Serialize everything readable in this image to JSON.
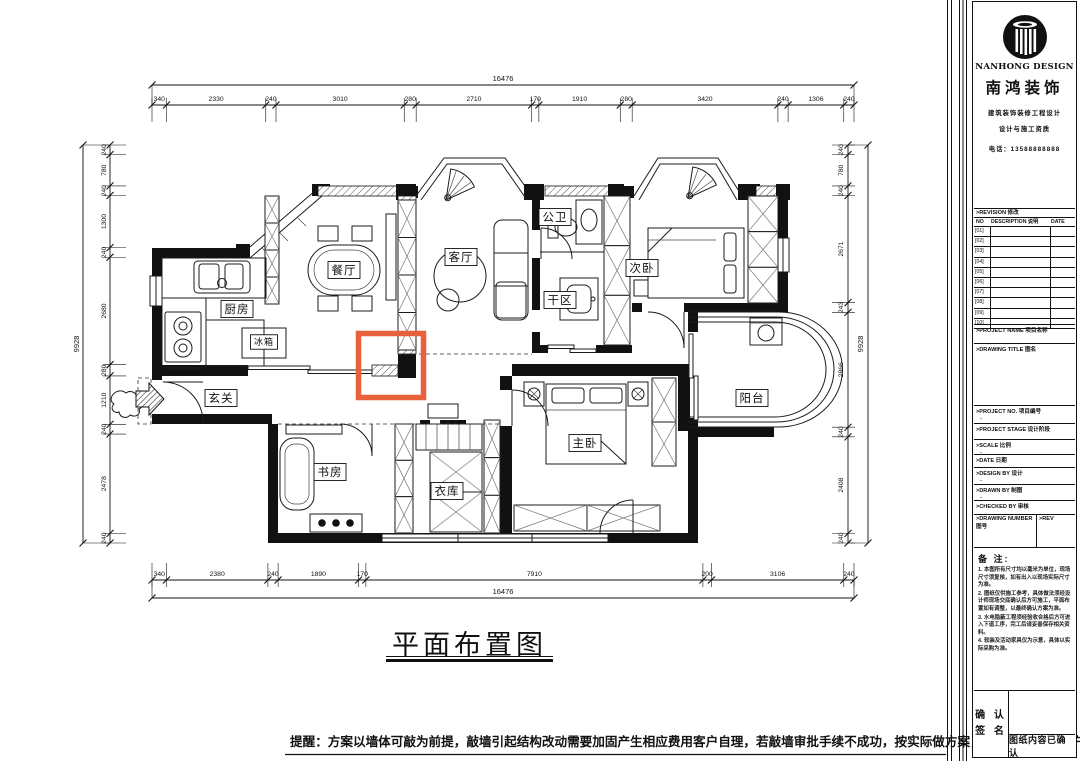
{
  "plan": {
    "title": "平面布置图",
    "reminder": "提醒：方案以墙体可敲为前提，敲墙引起结构改动需要加固产生相应费用客户自理，若敲墙审批手续不成功，按实际做方案，其中产生费用客户自理。",
    "highlight_color": "#E8613C",
    "rooms": [
      {
        "id": "kitchen",
        "label": "厨房"
      },
      {
        "id": "fridge",
        "label": "冰箱"
      },
      {
        "id": "dining",
        "label": "餐厅"
      },
      {
        "id": "living",
        "label": "客厅"
      },
      {
        "id": "bath",
        "label": "公卫"
      },
      {
        "id": "dry",
        "label": "干区"
      },
      {
        "id": "bed2",
        "label": "次卧"
      },
      {
        "id": "entry",
        "label": "玄关"
      },
      {
        "id": "study",
        "label": "书房"
      },
      {
        "id": "cloak",
        "label": "衣库"
      },
      {
        "id": "master",
        "label": "主卧"
      },
      {
        "id": "balcony",
        "label": "阳台"
      }
    ]
  },
  "dimensions": {
    "top": {
      "total": "16476",
      "segments": [
        340,
        2330,
        240,
        3010,
        280,
        2710,
        170,
        1910,
        280,
        3420,
        240,
        1306,
        240
      ]
    },
    "bottom": {
      "total": "16476",
      "segments": [
        340,
        2380,
        240,
        1890,
        170,
        7910,
        200,
        3106,
        240
      ]
    },
    "left": {
      "total": "9928",
      "segments": [
        240,
        780,
        240,
        1300,
        240,
        2680,
        280,
        1210,
        240,
        2478,
        240
      ]
    },
    "right": {
      "total": "9928",
      "segments": [
        240,
        780,
        240,
        2671,
        243,
        2866,
        240,
        2408,
        240
      ]
    }
  },
  "title_block": {
    "brand_en": "NANHONG DESIGN",
    "brand_cn": "南鸿装饰",
    "sub1": "建筑装饰装修工程设计",
    "sub2": "设计与施工资质",
    "sub3": "电话：13588888888",
    "revision": {
      "header": ">REVISION 修改",
      "col_no": "NO",
      "col_desc": "DESCRIPTION 说明",
      "col_date": "DATE",
      "rows": [
        "01",
        "02",
        "03",
        "04",
        "05",
        "06",
        "07",
        "08",
        "09",
        "10"
      ]
    },
    "fields": {
      "project_name": ">PROJECT NAME 项目名称",
      "drawing_title": ">DRAWING TITLE 图名",
      "project_no": ">PROJECT NO. 项目编号",
      "project_no_value": "-",
      "project_stage": ">PROJECT STAGE 设计阶段",
      "scale": ">SCALE 比例",
      "scale_value": "-",
      "date": ">DATE 日期",
      "design_by": ">DESIGN BY 设计",
      "design_by_value": "-",
      "drawn_by": ">DRAWN BY 制图",
      "drawn_by_value": "-",
      "checked_by": ">CHECKED BY 审核",
      "drawing_number": ">DRAWING NUMBER 图号",
      "rev": ">REV"
    },
    "notes_title": "备 注:",
    "notes": [
      "1. 本图所有尺寸均以毫米为单位，现场尺寸须复核，如有出入以现场实际尺寸为准。",
      "2. 图纸仅供施工参考，具体做法须经设计师现场交底确认后方可施工，平面布置如有调整，以最终确认方案为准。",
      "3. 水电隐蔽工程须经验收合格后方可进入下道工序，完工后请妥善保存相关资料。",
      "4. 软装及活动家具仅为示意，具体以实际采购为准。"
    ],
    "confirm_line1": "确 认",
    "confirm_line2": "签 名",
    "confirm_text": "图纸内容已确认"
  }
}
